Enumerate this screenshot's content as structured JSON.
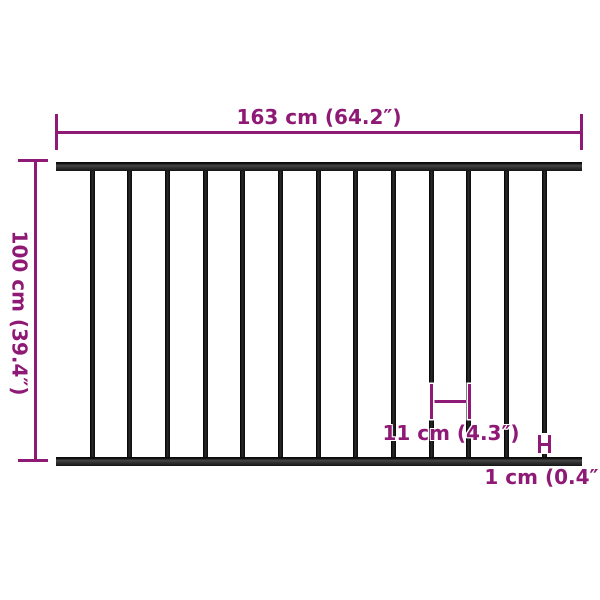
{
  "diagram": {
    "background": "#ffffff",
    "colors": {
      "dimension_accent": "#8e1a75",
      "fence": "#141414"
    },
    "fence": {
      "bars_count": 13
    }
  },
  "dimensions": {
    "width": {
      "label": "163 cm (64.2″)"
    },
    "height": {
      "label": "100 cm (39.4″)"
    },
    "bar_gap": {
      "label": "11 cm (4.3″)"
    },
    "bar_thickness": {
      "label": "1 cm (0.4″)"
    }
  }
}
